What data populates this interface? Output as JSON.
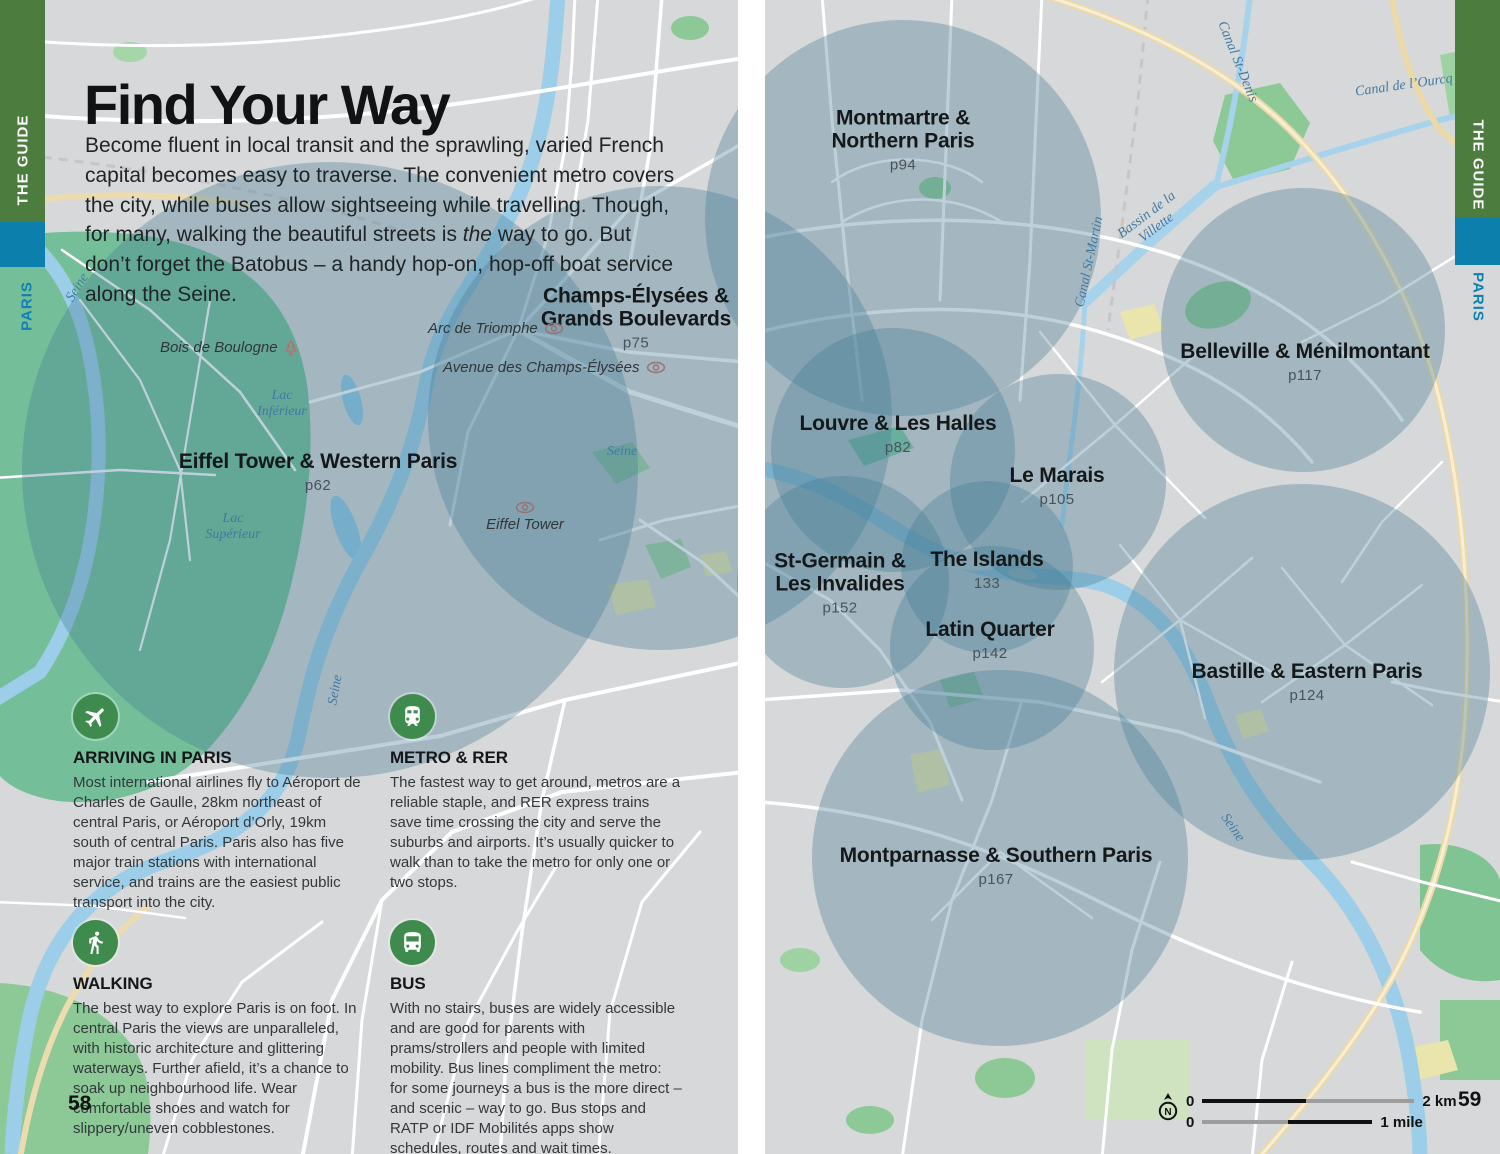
{
  "colors": {
    "sidebar_green": "#4c7d3f",
    "sidebar_blue": "#0d7fad",
    "icon_green": "#3f8b4d",
    "neighborhood_circle": "rgba(70,122,148,0.35)",
    "water": "#9ccde9",
    "map_base": "#d7d8d9"
  },
  "left_page": {
    "page_number": "58",
    "tabs": {
      "guide": "THE GUIDE",
      "city": "PARIS"
    },
    "title": "Find Your Way",
    "intro": {
      "part1": "Become fluent in local transit and the sprawling, varied French capital becomes easy to traverse. The convenient metro covers the city, while buses allow sightseeing while travelling. Though, for many, walking the beautiful streets is ",
      "italic": "the",
      "part2": " way to go. But don’t forget the Batobus – a handy hop-on, hop-off boat service along the Seine."
    },
    "neighborhoods": [
      {
        "name": "Champs-Élysées & Grands Boulevards",
        "page": "p75"
      },
      {
        "name": "Eiffel Tower & Western Paris",
        "page": "p62"
      }
    ],
    "poi": {
      "bois": "Bois de Boulogne",
      "arc": "Arc de Triomphe",
      "avenue": "Avenue des Champs-Élysées",
      "eiffel": "Eiffel Tower"
    },
    "water": {
      "seine_west": "Seine",
      "seine_center": "Seine",
      "seine_south": "Seine",
      "lac_inferieur": "Lac Inférieur",
      "lac_superieur": "Lac Supérieur"
    },
    "sections": [
      {
        "heading": "ARRIVING IN PARIS",
        "icon": "plane-icon",
        "body": "Most international airlines fly to Aéroport de Charles de Gaulle, 28km northeast of central Paris, or Aéroport d’Orly, 19km south of central Paris. Paris also has five major train stations with international service, and trains are the easiest public transport into the city."
      },
      {
        "heading": "METRO & RER",
        "icon": "train-icon",
        "body": "The fastest way to get around, metros are a reliable staple, and RER express trains save time crossing the city and serve the suburbs and airports. It’s usually quicker to walk than to take the metro for only one or two stops."
      },
      {
        "heading": "WALKING",
        "icon": "walking-icon",
        "body": "The best way to explore Paris is on foot. In central Paris the views are unparalleled, with historic architecture and glittering waterways. Further afield, it’s a chance to soak up neighbourhood life. Wear comfortable shoes and watch for slippery/uneven cobblestones."
      },
      {
        "heading": "BUS",
        "icon": "bus-icon",
        "body": "With no stairs, buses are widely accessible and are good for parents with prams/strollers and people with limited mobility. Bus lines compliment the metro: for some journeys a bus is the more direct – and scenic – way to go. Bus stops and RATP or IDF Mobilités apps show schedules, routes and wait times."
      }
    ]
  },
  "right_page": {
    "page_number": "59",
    "tabs": {
      "guide": "THE GUIDE",
      "city": "PARIS"
    },
    "neighborhoods": [
      {
        "name": "Montmartre & Northern Paris",
        "page": "p94"
      },
      {
        "name": "Belleville & Ménilmontant",
        "page": "p117"
      },
      {
        "name": "Louvre & Les Halles",
        "page": "p82"
      },
      {
        "name": "Le Marais",
        "page": "p105"
      },
      {
        "name": "The Islands",
        "page": "133"
      },
      {
        "name": "St-Germain & Les Invalides",
        "page": "p152"
      },
      {
        "name": "Latin Quarter",
        "page": "p142"
      },
      {
        "name": "Bastille & Eastern Paris",
        "page": "p124"
      },
      {
        "name": "Montparnasse & Southern Paris",
        "page": "p167"
      }
    ],
    "water": {
      "canal_st_denis": "Canal St-Denis",
      "canal_ourcq": "Canal de l’Ourcq",
      "bassin": "Bassin de la Villette",
      "canal_st_martin": "Canal St-Martin",
      "seine": "Seine"
    },
    "scale": {
      "zero_km": "0",
      "km_label": "2 km",
      "zero_mile": "0",
      "mile_label": "1 mile",
      "compass": "N"
    }
  }
}
